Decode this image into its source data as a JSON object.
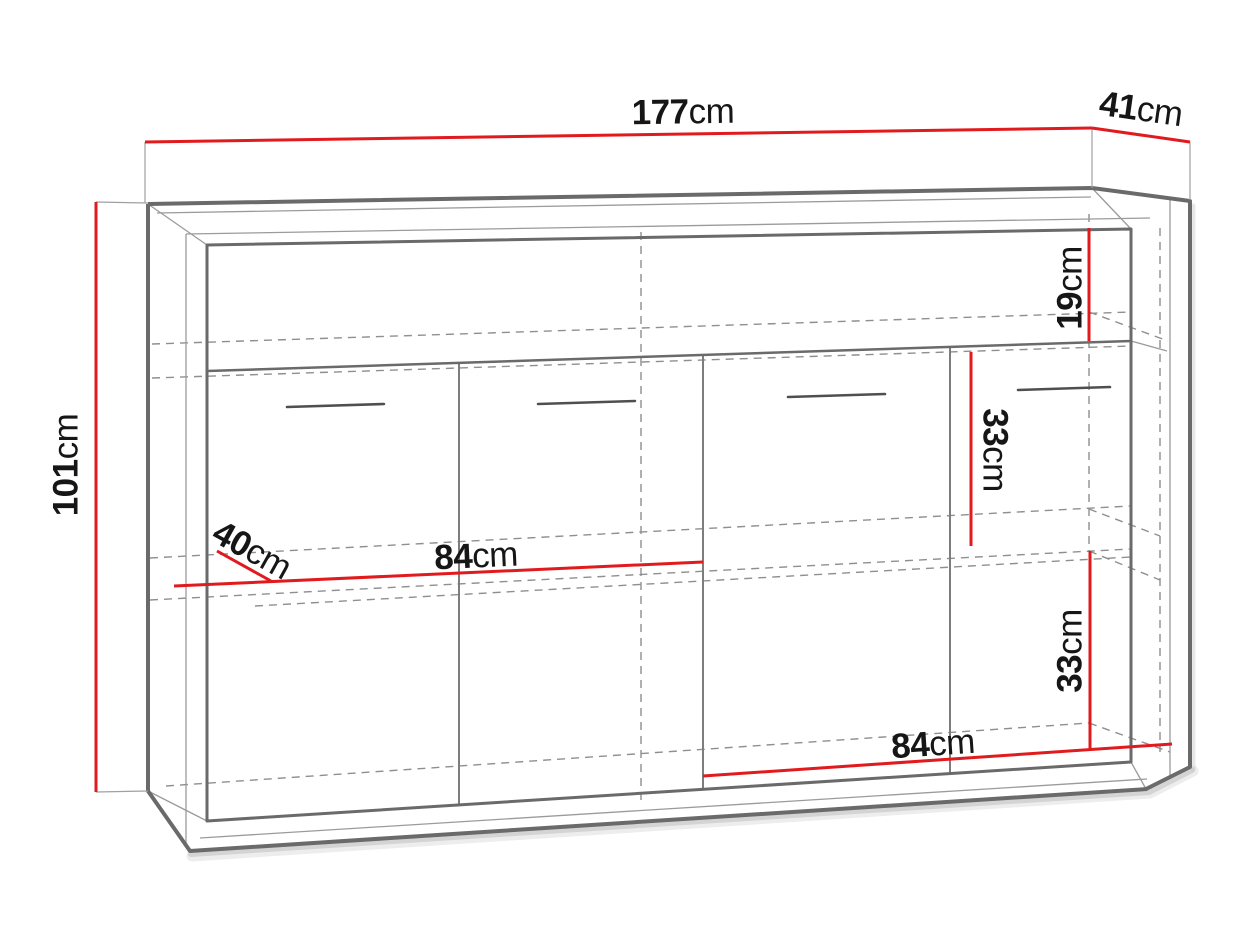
{
  "diagram": {
    "labels": {
      "width": {
        "value": "177",
        "unit": "cm"
      },
      "depth": {
        "value": "41",
        "unit": "cm"
      },
      "height": {
        "value": "101",
        "unit": "cm"
      },
      "top_section": {
        "value": "19",
        "unit": "cm"
      },
      "middle_section": {
        "value": "33",
        "unit": "cm"
      },
      "bottom_section": {
        "value": "33",
        "unit": "cm"
      },
      "shelf_depth": {
        "value": "40",
        "unit": "cm"
      },
      "middle_shelf_width": {
        "value": "84",
        "unit": "cm"
      },
      "bottom_shelf_width": {
        "value": "84",
        "unit": "cm"
      }
    },
    "colors": {
      "dimension": "#e11b1d",
      "outline": "#6a6a6a",
      "hidden": "#8f8f8f",
      "text": "#161616",
      "background": "#ffffff"
    }
  }
}
